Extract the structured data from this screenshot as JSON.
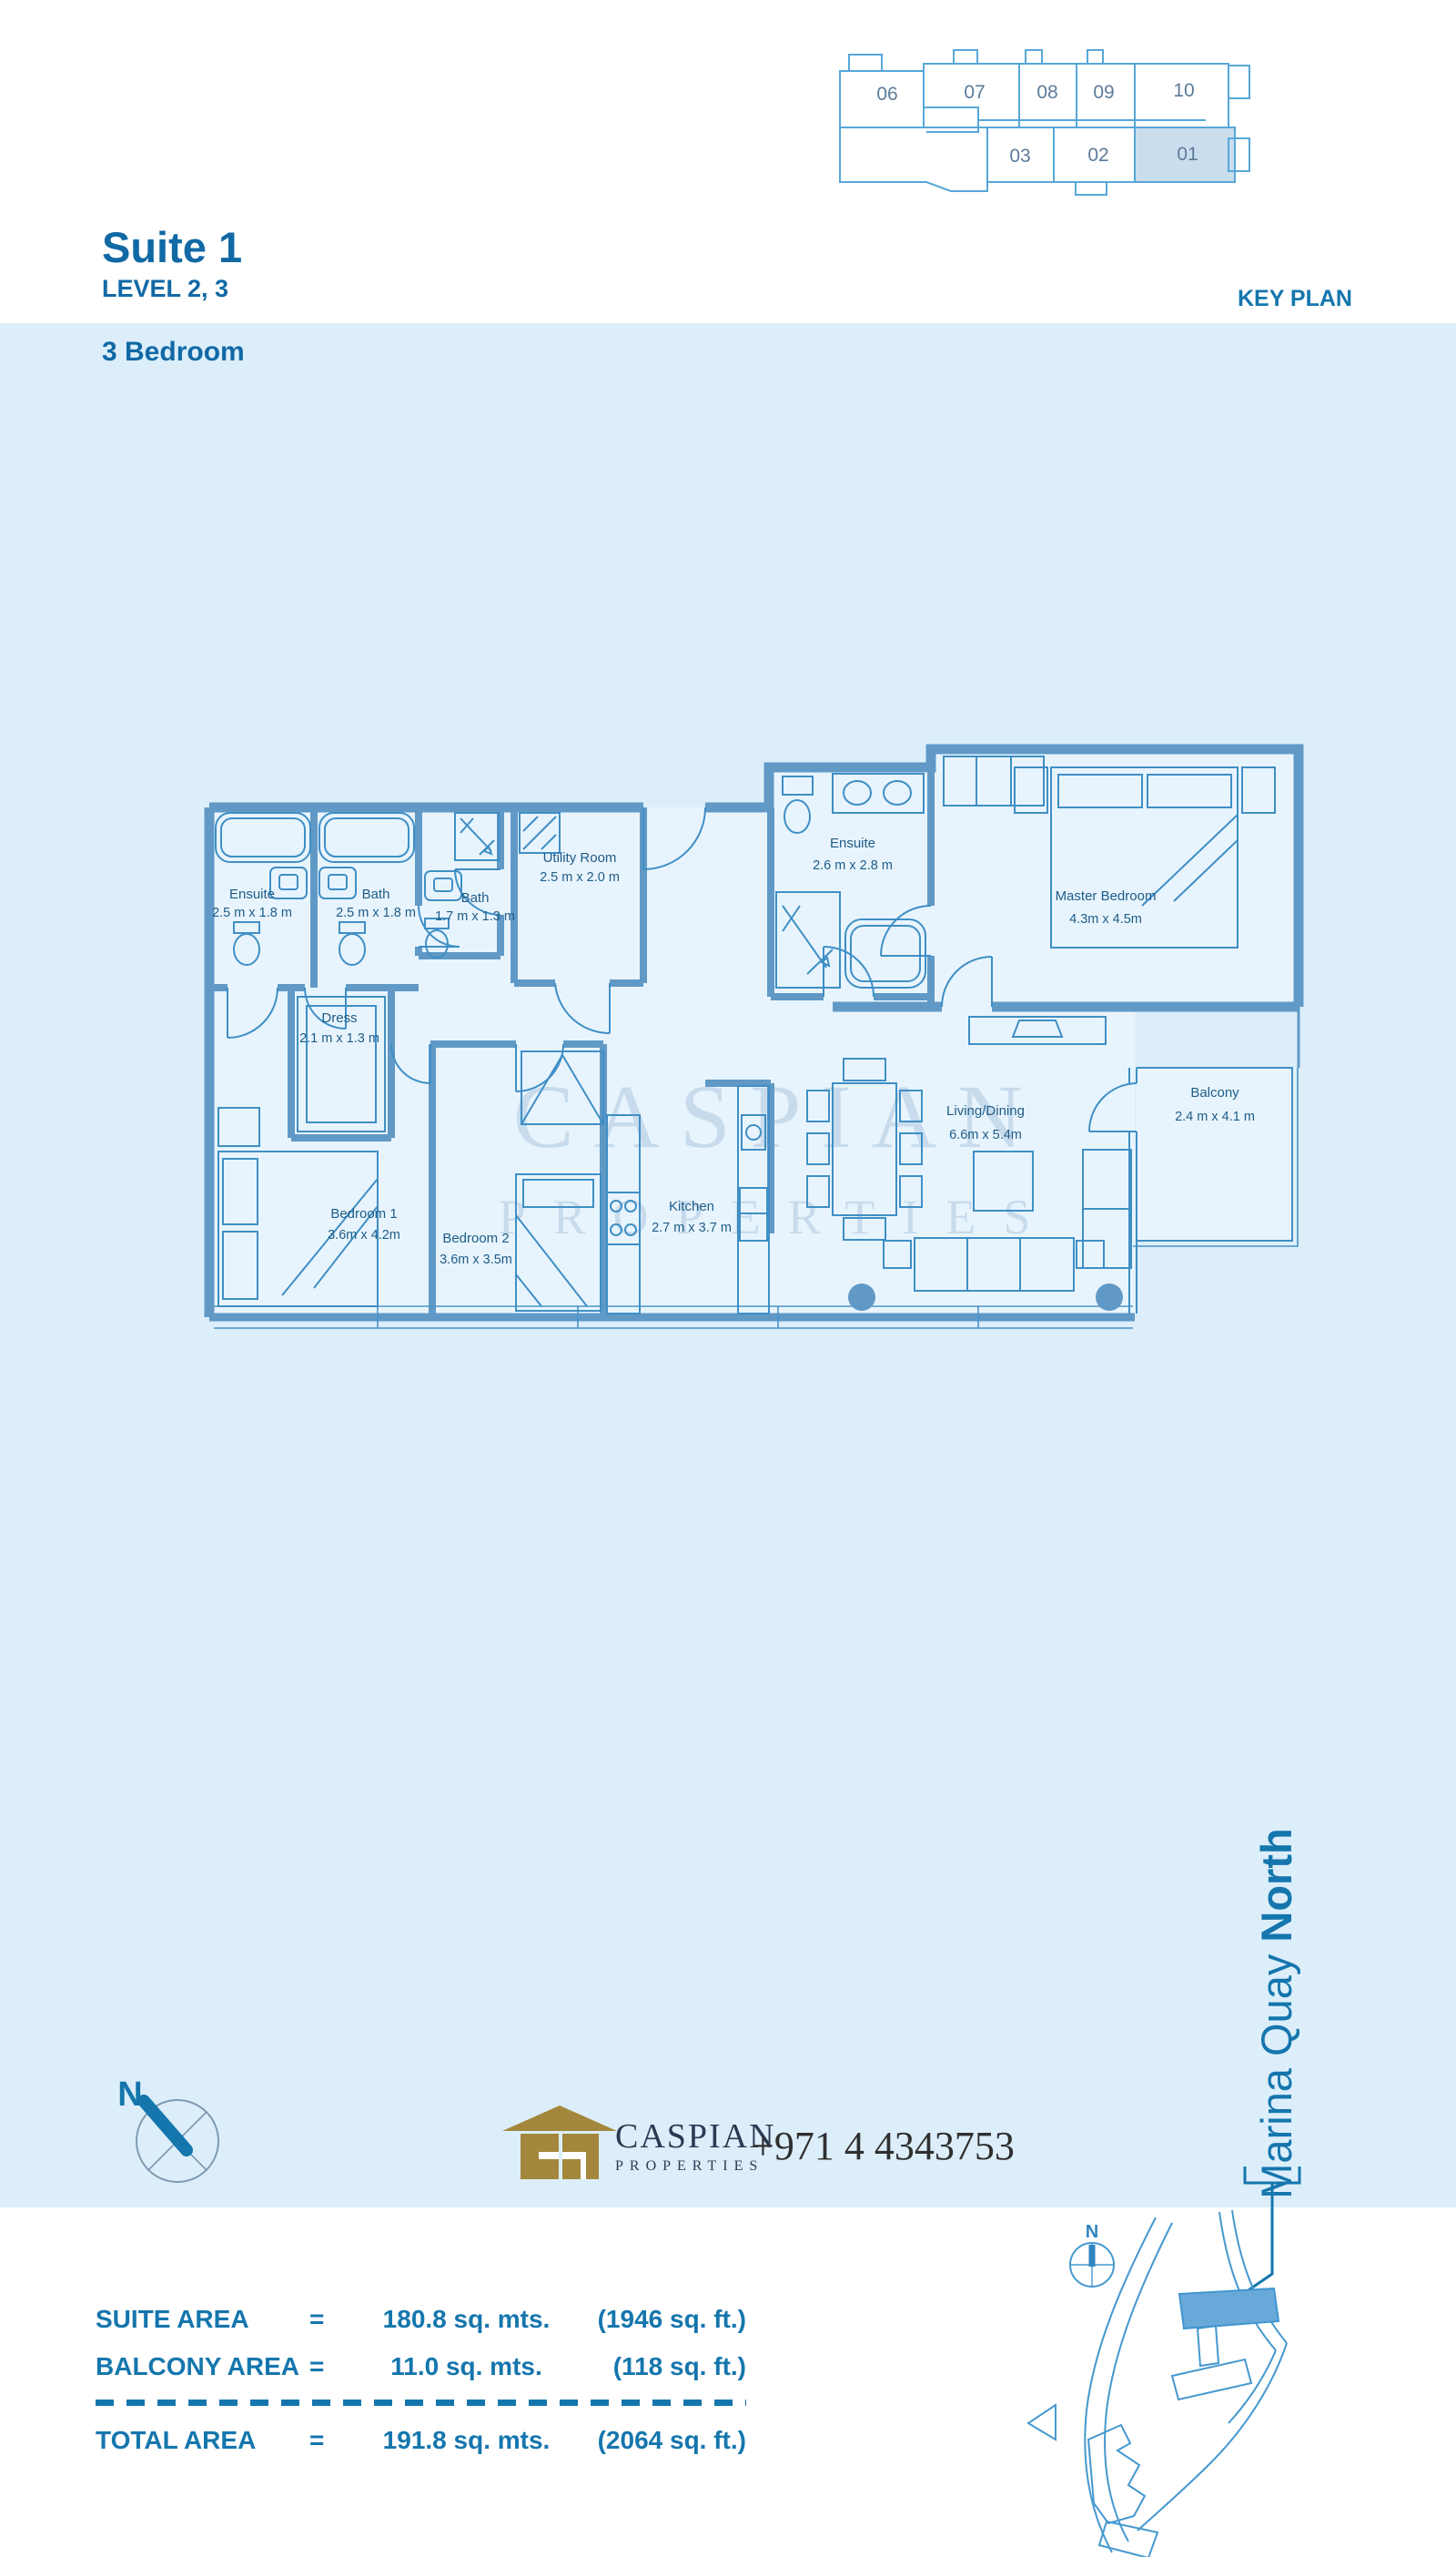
{
  "header": {
    "title": "Suite 1",
    "level": "LEVEL 2, 3",
    "type": "3 Bedroom",
    "key_plan_label": "KEY PLAN"
  },
  "key_plan": {
    "top_units": [
      "06",
      "07",
      "08",
      "09",
      "10"
    ],
    "bottom_units": [
      "03",
      "02",
      "01"
    ],
    "highlighted_unit": "01"
  },
  "floor_plan": {
    "watermark": {
      "line1": "CASPIAN",
      "line2": "PROPERTIES"
    },
    "rooms": [
      {
        "name": "Ensuite",
        "dims": "2.5 m x 1.8 m"
      },
      {
        "name": "Bath",
        "dims": "2.5 m x 1.8 m"
      },
      {
        "name": "Bath",
        "dims": "1.7 m x 1.3 m"
      },
      {
        "name": "Utility Room",
        "dims": "2.5 m x 2.0 m"
      },
      {
        "name": "Dress",
        "dims": "2.1 m x 1.3 m"
      },
      {
        "name": "Ensuite",
        "dims": "2.6 m x 2.8 m"
      },
      {
        "name": "Master Bedroom",
        "dims": "4.3m x 4.5m"
      },
      {
        "name": "Bedroom 1",
        "dims": "3.6m x 4.2m"
      },
      {
        "name": "Bedroom 2",
        "dims": "3.6m x 3.5m"
      },
      {
        "name": "Kitchen",
        "dims": "2.7 m x 3.7 m"
      },
      {
        "name": "Living/Dining",
        "dims": "6.6m x 5.4m"
      },
      {
        "name": "Balcony",
        "dims": "2.4 m x 4.1 m"
      }
    ]
  },
  "compass": {
    "north_label": "N"
  },
  "branding": {
    "company": "CASPIAN",
    "company_sub": "PROPERTIES",
    "phone": "+971 4 4343753"
  },
  "location": {
    "name_regular": "Marina Quay ",
    "name_bold": "North",
    "map_north_label": "N"
  },
  "areas": {
    "suite": {
      "label": "SUITE AREA",
      "eq": "=",
      "metric": "180.8 sq. mts.",
      "imperial": "(1946 sq. ft.)"
    },
    "balcony": {
      "label": "BALCONY AREA",
      "eq": "=",
      "metric": "11.0 sq. mts.",
      "imperial": "(118 sq. ft.)"
    },
    "total": {
      "label": "TOTAL AREA",
      "eq": "=",
      "metric": "191.8 sq. mts.",
      "imperial": "(2064 sq. ft.)"
    }
  },
  "colors": {
    "band_blue": "#dceefa",
    "plan_fill": "#e8f4fd",
    "wall_blue": "#6099c6",
    "line_blue": "#3f8fc5",
    "accent_text": "#1576ad",
    "label_blue": "#1d5c88",
    "keyplan_line": "#58a7d8",
    "keyplan_text": "#5c7b99",
    "highlight_fill": "#cadded",
    "logo_gold": "#a3873c",
    "logo_text": "#2b3a52",
    "watermark": "#a6c2da"
  }
}
